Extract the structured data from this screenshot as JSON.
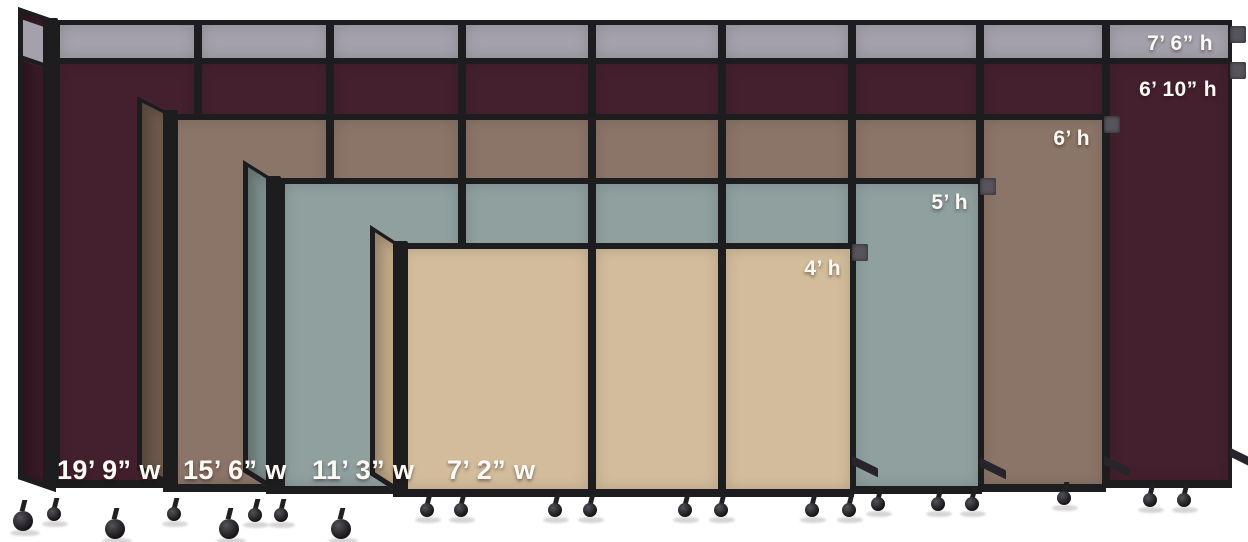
{
  "image": {
    "background_color": "#ffffff",
    "frame_color": "#1d1c1e",
    "partitions": [
      {
        "size_name": "largest",
        "fabric_hex": "#44202e",
        "return_hex": "#381a26",
        "panel_count": 9,
        "labels": {
          "height": "6’ 10” h",
          "width": "19’ 9” w"
        },
        "topper": {
          "fabric_hex": "#a5a1ac",
          "label_height": "7’ 6” h"
        }
      },
      {
        "size_name": "large",
        "fabric_hex": "#8b7568",
        "return_hex": "#6d594c",
        "panel_count": 7,
        "labels": {
          "height": "6’ h",
          "width": "15’ 6” w"
        }
      },
      {
        "size_name": "medium",
        "fabric_hex": "#8fa09f",
        "return_hex": "#7e908e",
        "panel_count": 5,
        "labels": {
          "height": "5’ h",
          "width": "11’ 3” w"
        }
      },
      {
        "size_name": "small",
        "fabric_hex": "#d2bc9b",
        "return_hex": "#c1aa88",
        "panel_count": 3,
        "labels": {
          "height": "4’ h",
          "width": "7’ 2” w"
        }
      }
    ]
  }
}
